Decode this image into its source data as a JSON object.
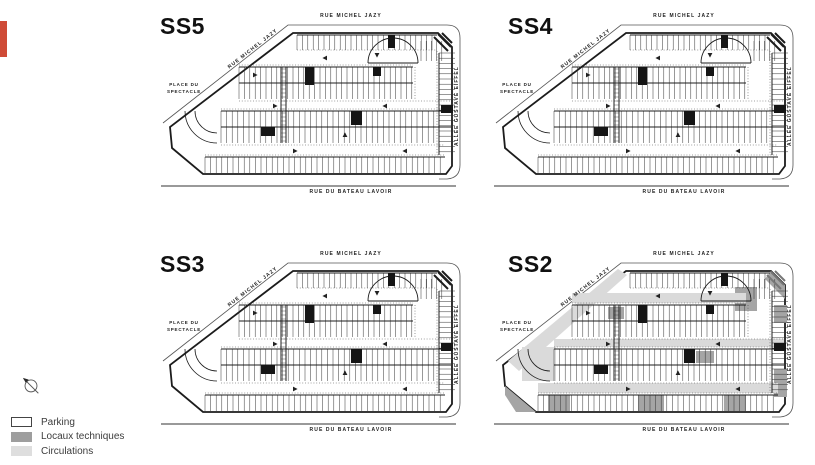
{
  "accent_bar": {
    "color": "#cf4b37"
  },
  "plans": [
    {
      "id": "ss5",
      "title": "SS5",
      "variant": "standard"
    },
    {
      "id": "ss4",
      "title": "SS4",
      "variant": "standard"
    },
    {
      "id": "ss3",
      "title": "SS3",
      "variant": "standard"
    },
    {
      "id": "ss2",
      "title": "SS2",
      "variant": "technical"
    }
  ],
  "streets": {
    "top": "RUE MICHEL JAZY",
    "diagonal": "RUE MICHEL JAZY",
    "right": "ALLEE GUSTAVE EIFFEL",
    "bottom": "RUE DU BATEAU LAVOIR",
    "place": "PLACE DU SPECTACLE"
  },
  "legend": {
    "items": [
      {
        "label": "Parking",
        "fill": "#ffffff",
        "border": "#444444"
      },
      {
        "label": "Locaux techniques",
        "fill": "#9e9e9e",
        "border": "#9e9e9e"
      },
      {
        "label": "Circulations",
        "fill": "#dedede",
        "border": "#dedede"
      }
    ]
  },
  "colors": {
    "line": "#1c1c1c",
    "technical_gray": "#a5a5a5",
    "circulation_gray": "#dadada"
  }
}
